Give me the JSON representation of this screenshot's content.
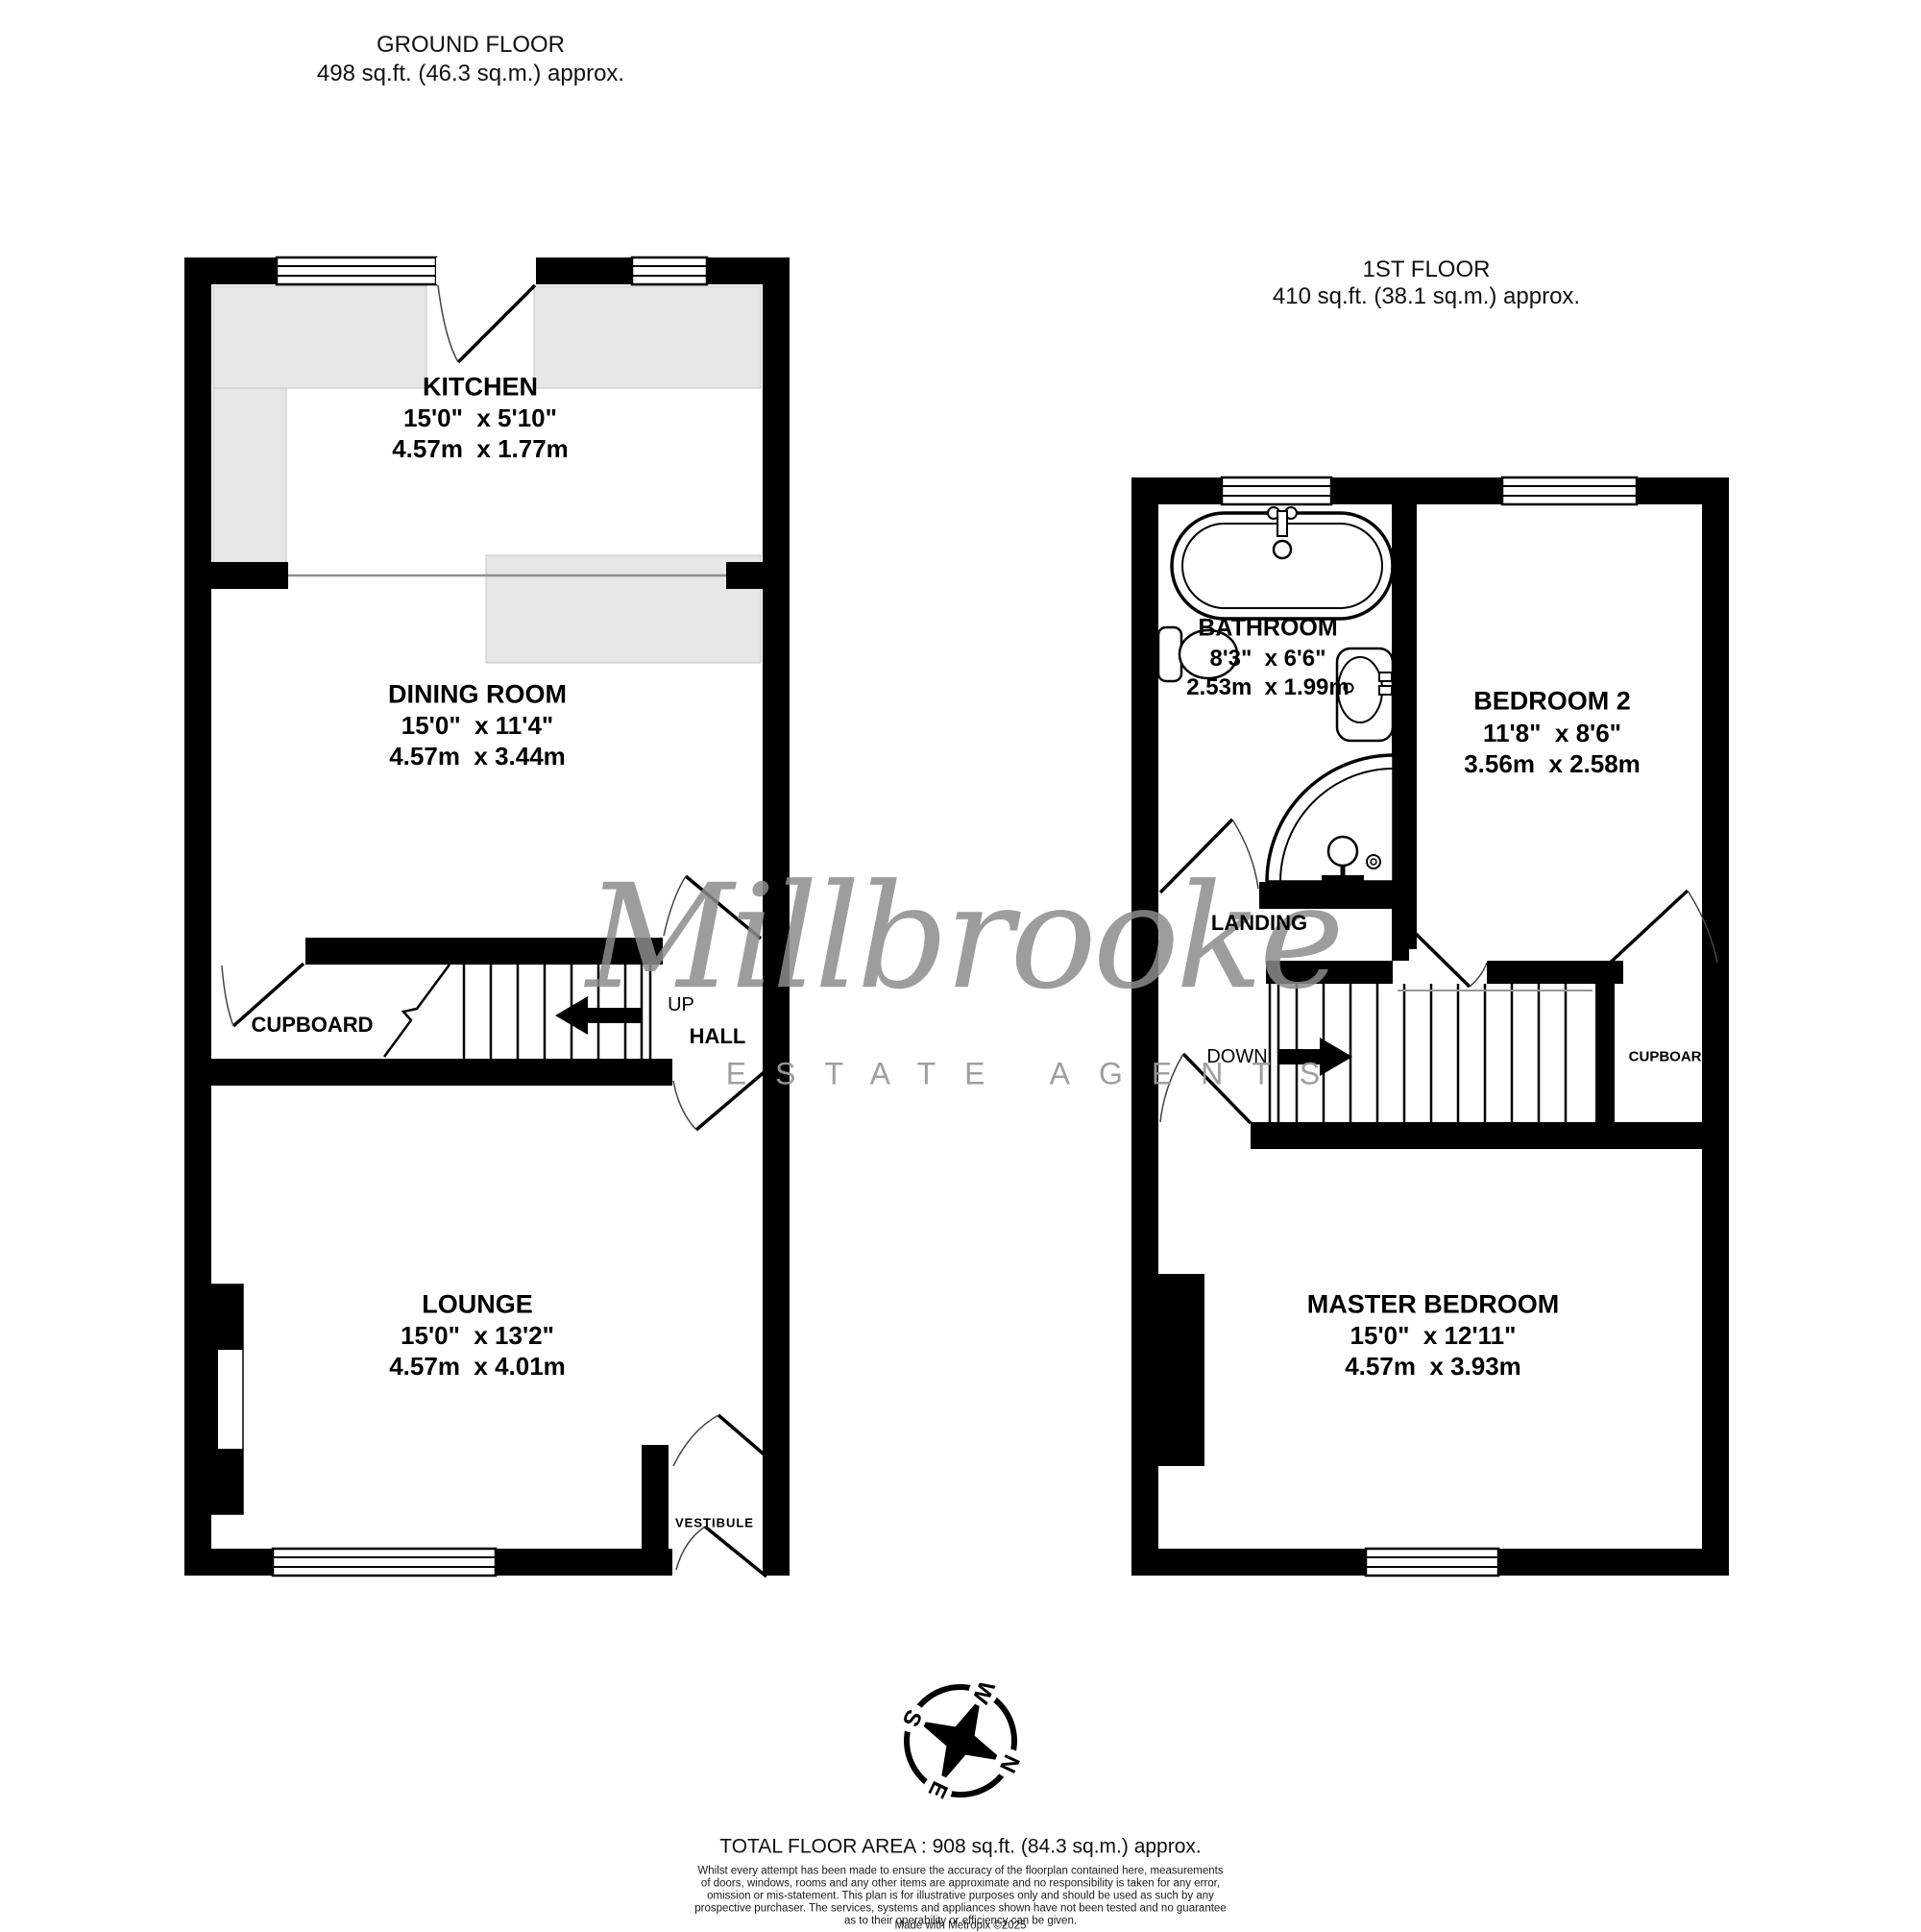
{
  "ground_floor": {
    "title": "GROUND FLOOR",
    "area": "498 sq.ft. (46.3 sq.m.) approx.",
    "rooms": {
      "kitchen": {
        "name": "KITCHEN",
        "imperial": "15'0\"  x 5'10\"",
        "metric": "4.57m  x 1.77m"
      },
      "dining": {
        "name": "DINING ROOM",
        "imperial": "15'0\"  x 11'4\"",
        "metric": "4.57m  x 3.44m"
      },
      "lounge": {
        "name": "LOUNGE",
        "imperial": "15'0\"  x 13'2\"",
        "metric": "4.57m  x 4.01m"
      },
      "cupboard": {
        "name": "CUPBOARD"
      },
      "hall": {
        "name": "HALL"
      },
      "vestibule": {
        "name": "VESTIBULE"
      }
    },
    "stairs_label": "UP"
  },
  "first_floor": {
    "title": "1ST FLOOR",
    "area": "410 sq.ft. (38.1 sq.m.) approx.",
    "rooms": {
      "bathroom": {
        "name": "BATHROOM",
        "imperial": "8'3\"  x 6'6\"",
        "metric": "2.53m  x 1.99m"
      },
      "bedroom2": {
        "name": "BEDROOM 2",
        "imperial": "11'8\"  x 8'6\"",
        "metric": "3.56m  x 2.58m"
      },
      "master": {
        "name": "MASTER BEDROOM",
        "imperial": "15'0\"  x 12'11\"",
        "metric": "4.57m  x 3.93m"
      },
      "landing": {
        "name": "LANDING"
      },
      "cupboard": {
        "name": "CUPBOARD"
      }
    },
    "stairs_label": "DOWN"
  },
  "watermark": {
    "name": "Millbrooke",
    "tagline": "ESTATE AGENTS"
  },
  "compass": {
    "n": "N",
    "e": "E",
    "s": "S",
    "w": "W"
  },
  "footer": {
    "total": "TOTAL FLOOR AREA : 908 sq.ft. (84.3 sq.m.) approx.",
    "disclaimer_lines": [
      "Whilst every attempt has been made to ensure the accuracy of the floorplan contained here, measurements",
      "of doors, windows, rooms and any other items are approximate and no responsibility is taken for any error,",
      "omission or mis-statement. This plan is for illustrative purposes only and should be used as such by any",
      "prospective purchaser. The services, systems and appliances shown have not been tested and no guarantee",
      "as to their operability or efficiency can be given.",
      "Made with Metropix ©2025"
    ]
  },
  "colors": {
    "wall": "#000000",
    "counter": "#e7e7e7",
    "watermark": "#8c8c8c"
  }
}
